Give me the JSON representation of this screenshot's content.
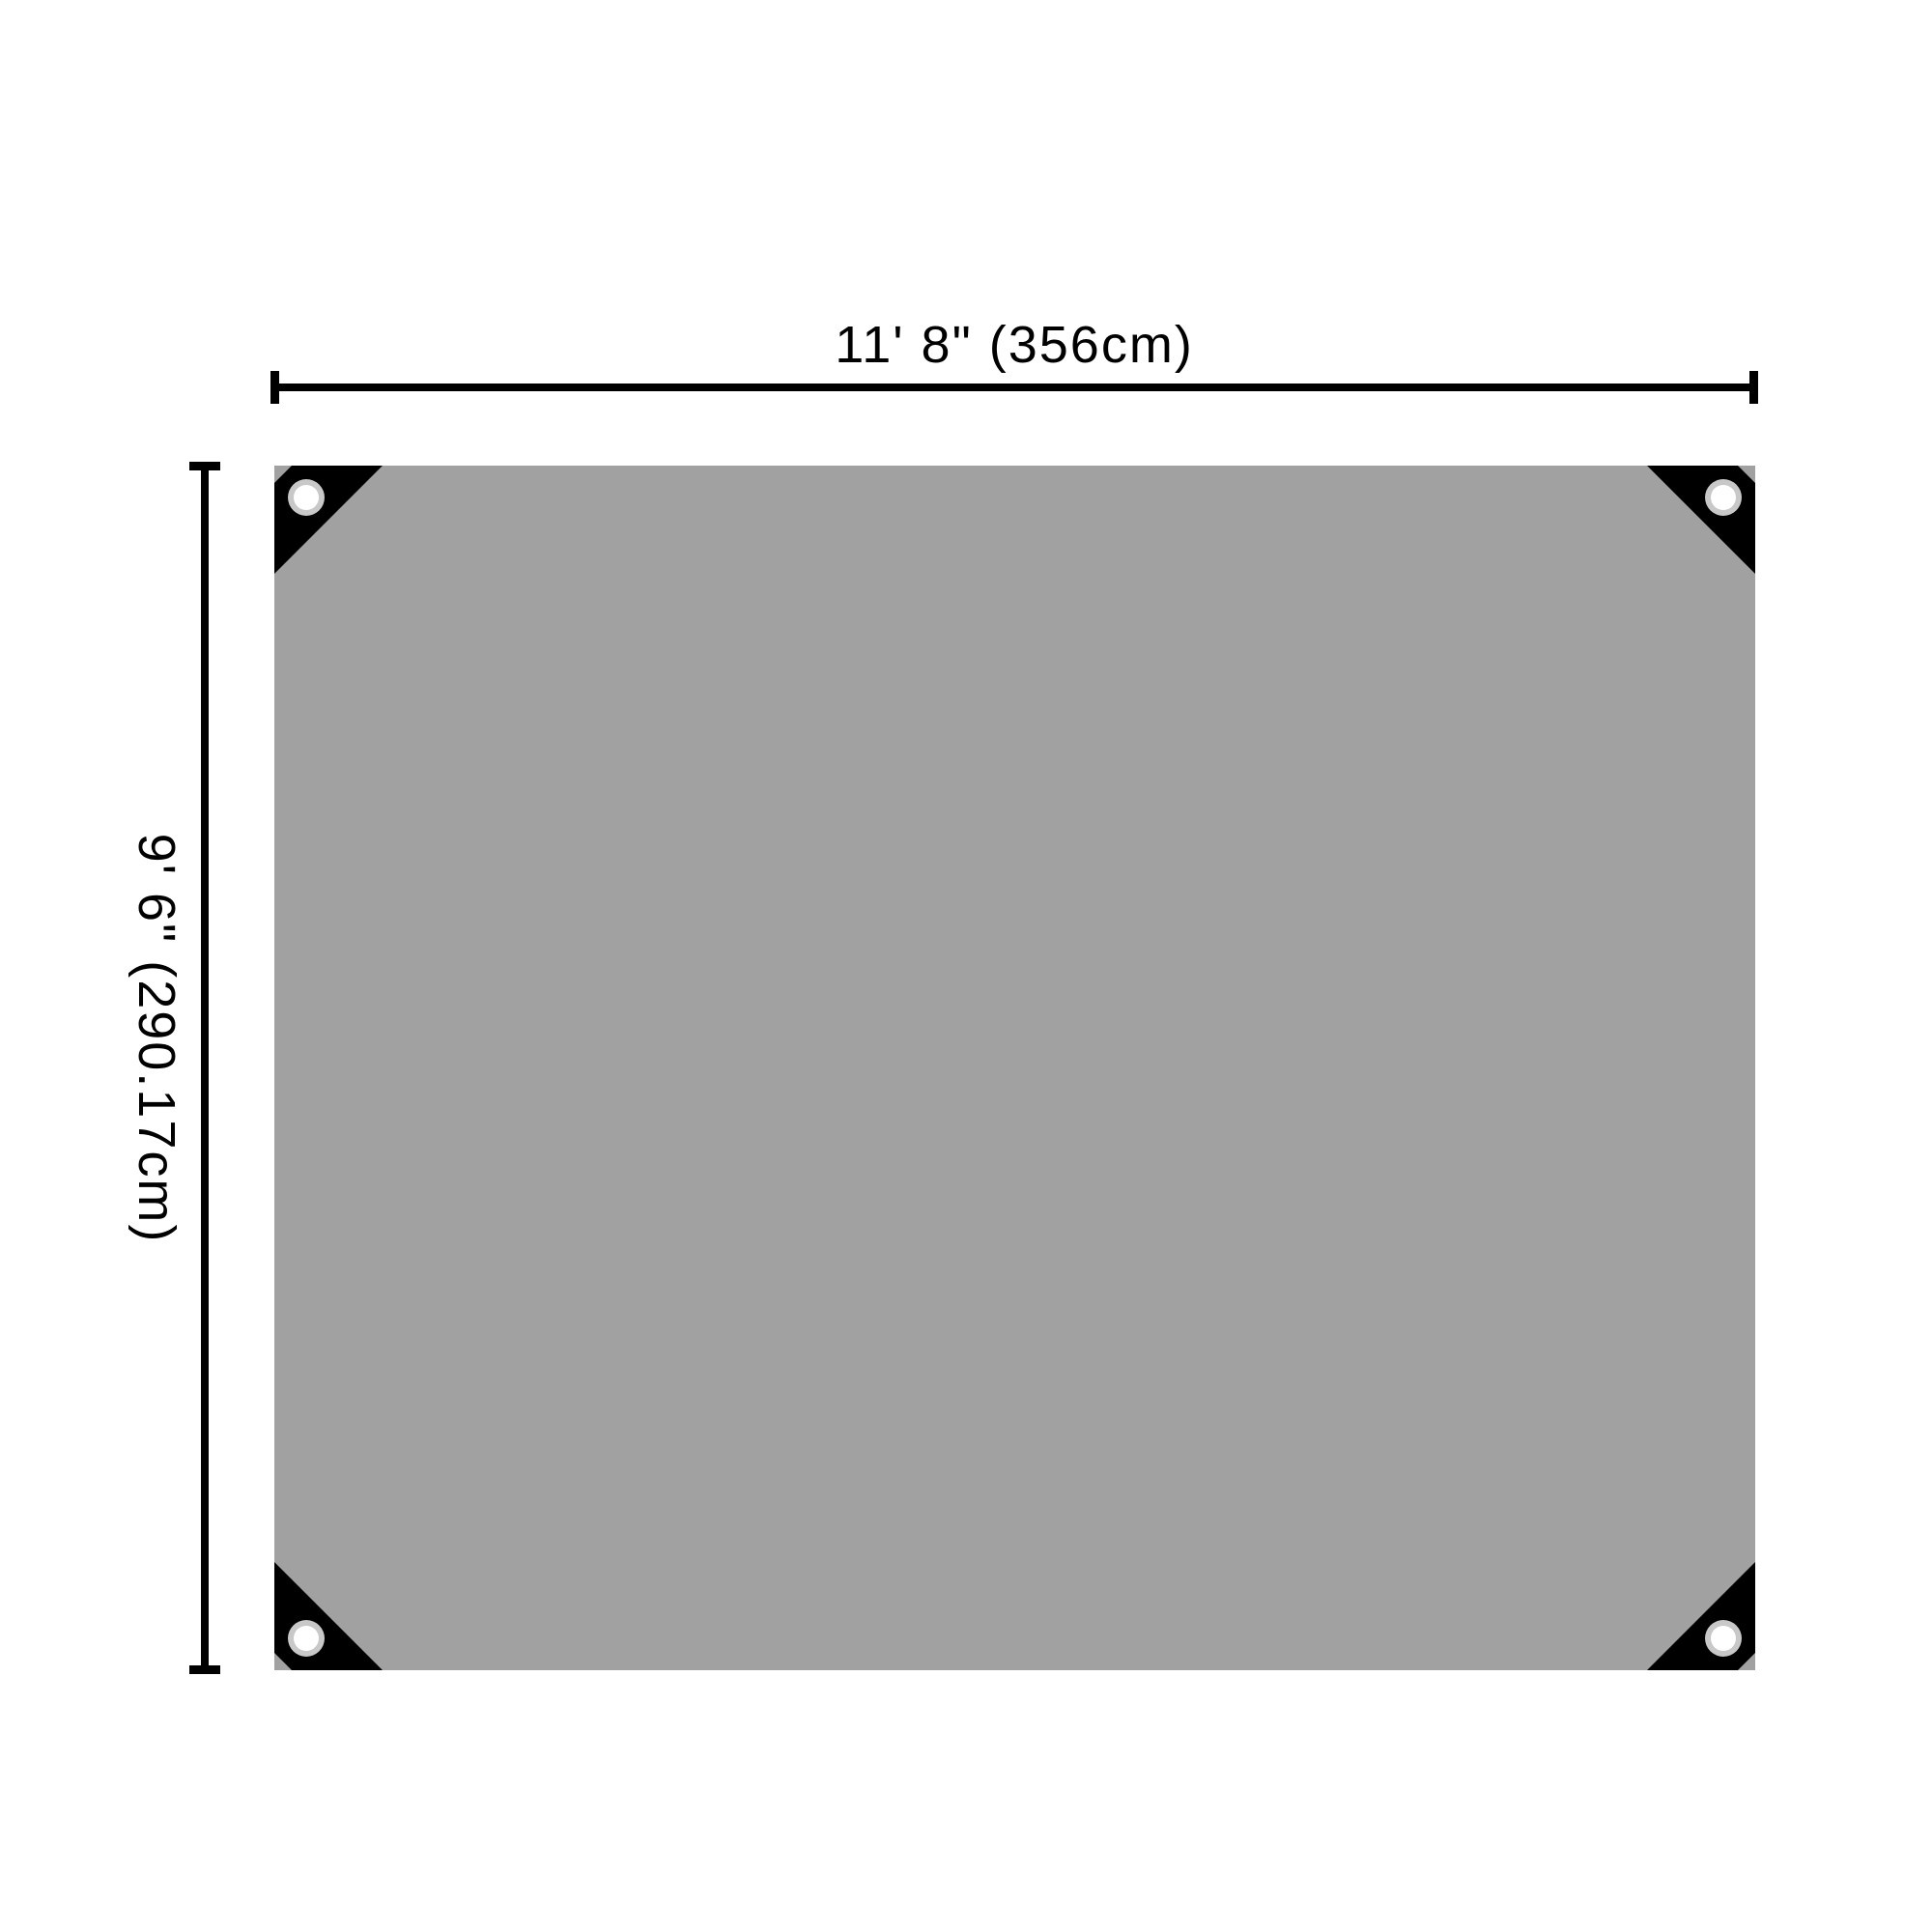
{
  "diagram": {
    "width_dimension": {
      "label": "11' 8\" (356cm)"
    },
    "height_dimension": {
      "label": "9' 6\" (290.17cm)"
    },
    "colors": {
      "background": "#ffffff",
      "tarp": "#a1a1a1",
      "corner_patch": "#000000",
      "grommet_ring": "#c8c8c8",
      "grommet_hole": "#ffffff",
      "dimension_line": "#000000"
    }
  }
}
